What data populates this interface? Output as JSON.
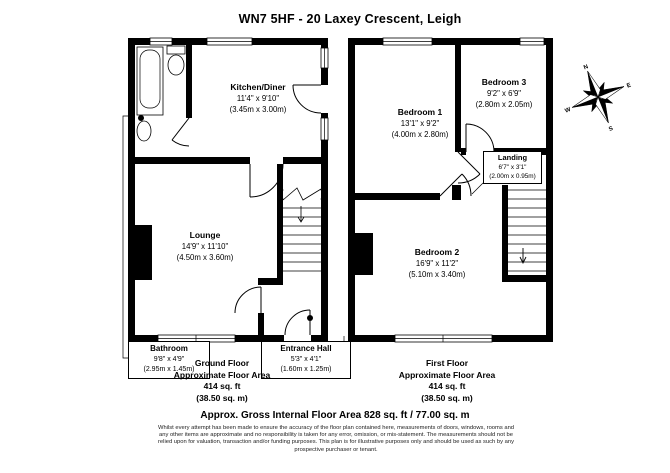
{
  "title": "WN7 5HF - 20 Laxey Crescent, Leigh",
  "ground_floor": {
    "rooms": {
      "kitchen": {
        "name": "Kitchen/Diner",
        "imperial": "11'4\" x 9'10\"",
        "metric": "(3.45m x 3.00m)"
      },
      "lounge": {
        "name": "Lounge",
        "imperial": "14'9\" x 11'10\"",
        "metric": "(4.50m x 3.60m)"
      },
      "bathroom": {
        "name": "Bathroom",
        "imperial": "9'8\" x 4'9\"",
        "metric": "(2.95m x 1.45m)"
      },
      "entrance_hall": {
        "name": "Entrance Hall",
        "imperial": "5'3\" x 4'1\"",
        "metric": "(1.60m x 1.25m)"
      }
    },
    "caption": [
      "Ground Floor",
      "Approximate Floor Area",
      "414 sq. ft",
      "(38.50 sq. m)"
    ]
  },
  "first_floor": {
    "rooms": {
      "bedroom1": {
        "name": "Bedroom 1",
        "imperial": "13'1\" x 9'2\"",
        "metric": "(4.00m x 2.80m)"
      },
      "bedroom2": {
        "name": "Bedroom 2",
        "imperial": "16'9\" x 11'2\"",
        "metric": "(5.10m x 3.40m)"
      },
      "bedroom3": {
        "name": "Bedroom 3",
        "imperial": "9'2\" x 6'9\"",
        "metric": "(2.80m x 2.05m)"
      },
      "landing": {
        "name": "Landing",
        "imperial": "6'7\" x 3'1\"",
        "metric": "(2.00m x 0.95m)"
      }
    },
    "caption": [
      "First Floor",
      "Approximate Floor Area",
      "414 sq. ft",
      "(38.50 sq. m)"
    ]
  },
  "compass": {
    "north": "N",
    "east": "E",
    "south": "S",
    "west": "W"
  },
  "footer": {
    "total": "Approx. Gross Internal Floor Area 828 sq. ft / 77.00 sq. m",
    "disclaimer": "Whilst every attempt has been made to ensure the accuracy of the floor plan contained here, measurements of doors, windows, rooms and any other items are approximate and no responsibility is taken for any error, omission, or mis-statement. The measurements should not be relied upon for valuation, transaction and/or funding purposes. This plan is for illustrative purposes only and should be used as such by any prospective purchaser or tenant."
  }
}
